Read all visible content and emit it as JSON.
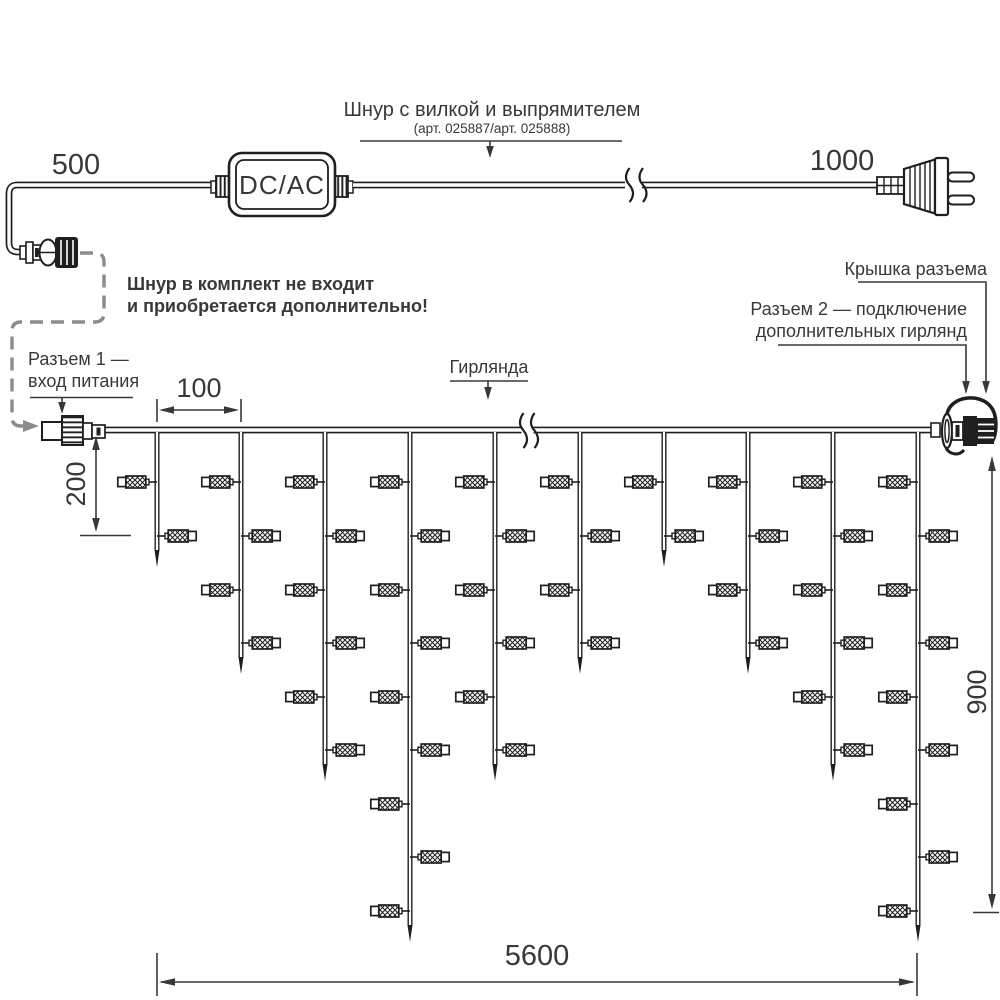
{
  "labels": {
    "cord_title": "Шнур с вилкой и выпрямителем",
    "cord_subtitle": "(арт. 025887/арт. 025888)",
    "dim_500": "500",
    "dim_1000": "1000",
    "converter": "DC/AC",
    "note_line1": "Шнур в комплект не входит",
    "note_line2": "и приобретается дополнительно!",
    "connector1_line1": "Разъем 1 —",
    "connector1_line2": "вход питания",
    "garland": "Гирлянда",
    "cap": "Крышка разъема",
    "connector2_line1": "Разъем 2 — подключение",
    "connector2_line2": "дополнительных гирлянд",
    "dim_100": "100",
    "dim_200": "200",
    "dim_900": "900",
    "dim_5600": "5600"
  },
  "garland": {
    "wire_y": 430,
    "drop_xs": [
      157,
      241,
      325,
      410,
      495,
      580,
      664,
      748,
      833,
      918
    ],
    "lamp_levels": [
      482,
      536,
      590,
      643,
      697,
      750,
      804,
      857,
      911
    ],
    "lamps_per_drop": [
      2,
      4,
      6,
      9,
      6,
      4,
      2,
      4,
      6,
      9
    ],
    "tip_extra": 31
  },
  "colors": {
    "line": "#1f1f1f",
    "text": "#383838",
    "dashed": "#8c8c8c"
  }
}
